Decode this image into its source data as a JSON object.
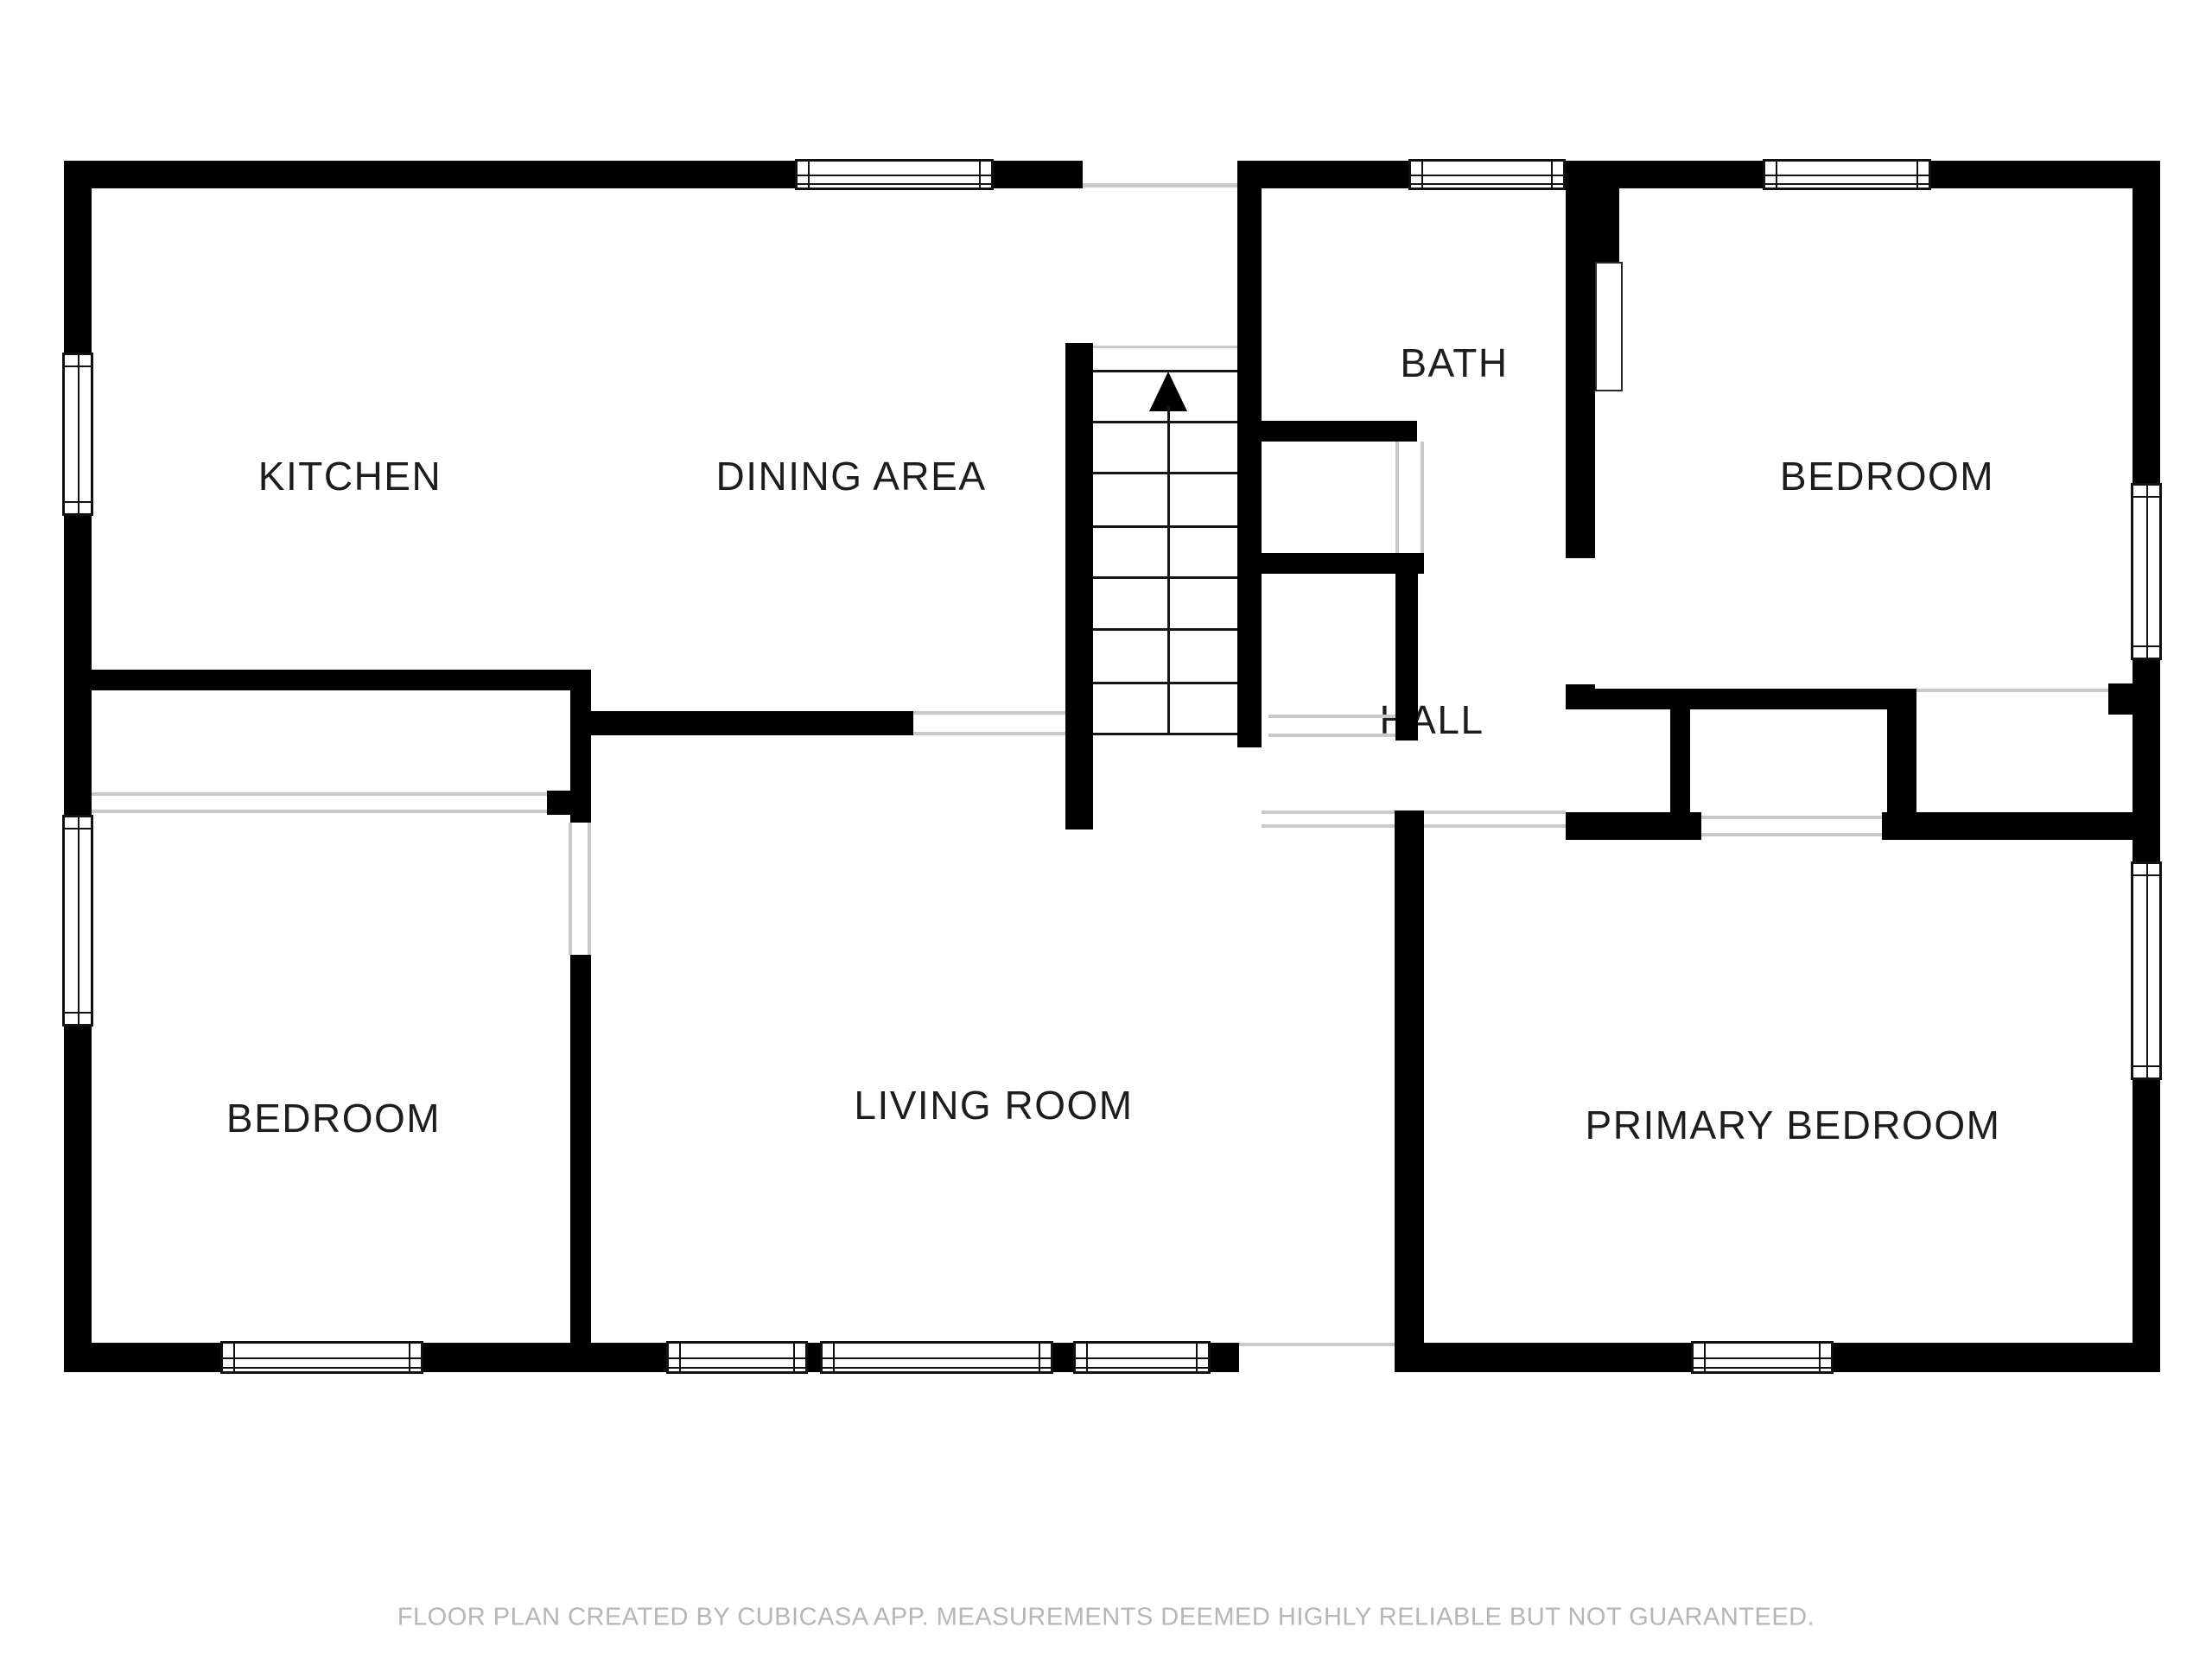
{
  "floor_plan": {
    "rooms": [
      {
        "label": "KITCHEN"
      },
      {
        "label": "DINING AREA"
      },
      {
        "label": "BATH"
      },
      {
        "label": "BEDROOM"
      },
      {
        "label": "HALL"
      },
      {
        "label": "BEDROOM"
      },
      {
        "label": "LIVING ROOM"
      },
      {
        "label": "PRIMARY BEDROOM"
      }
    ],
    "stairs": {
      "icon": "up-arrow"
    },
    "footer": "FLOOR PLAN CREATED BY CUBICASA APP. MEASUREMENTS DEEMED HIGHLY RELIABLE BUT NOT GUARANTEED.",
    "colors": {
      "wall": "#000000",
      "background": "#ffffff",
      "label_text": "#1d1d1f",
      "opening_line": "#c9c9c9",
      "footer_text": "#b6b6b6"
    }
  }
}
